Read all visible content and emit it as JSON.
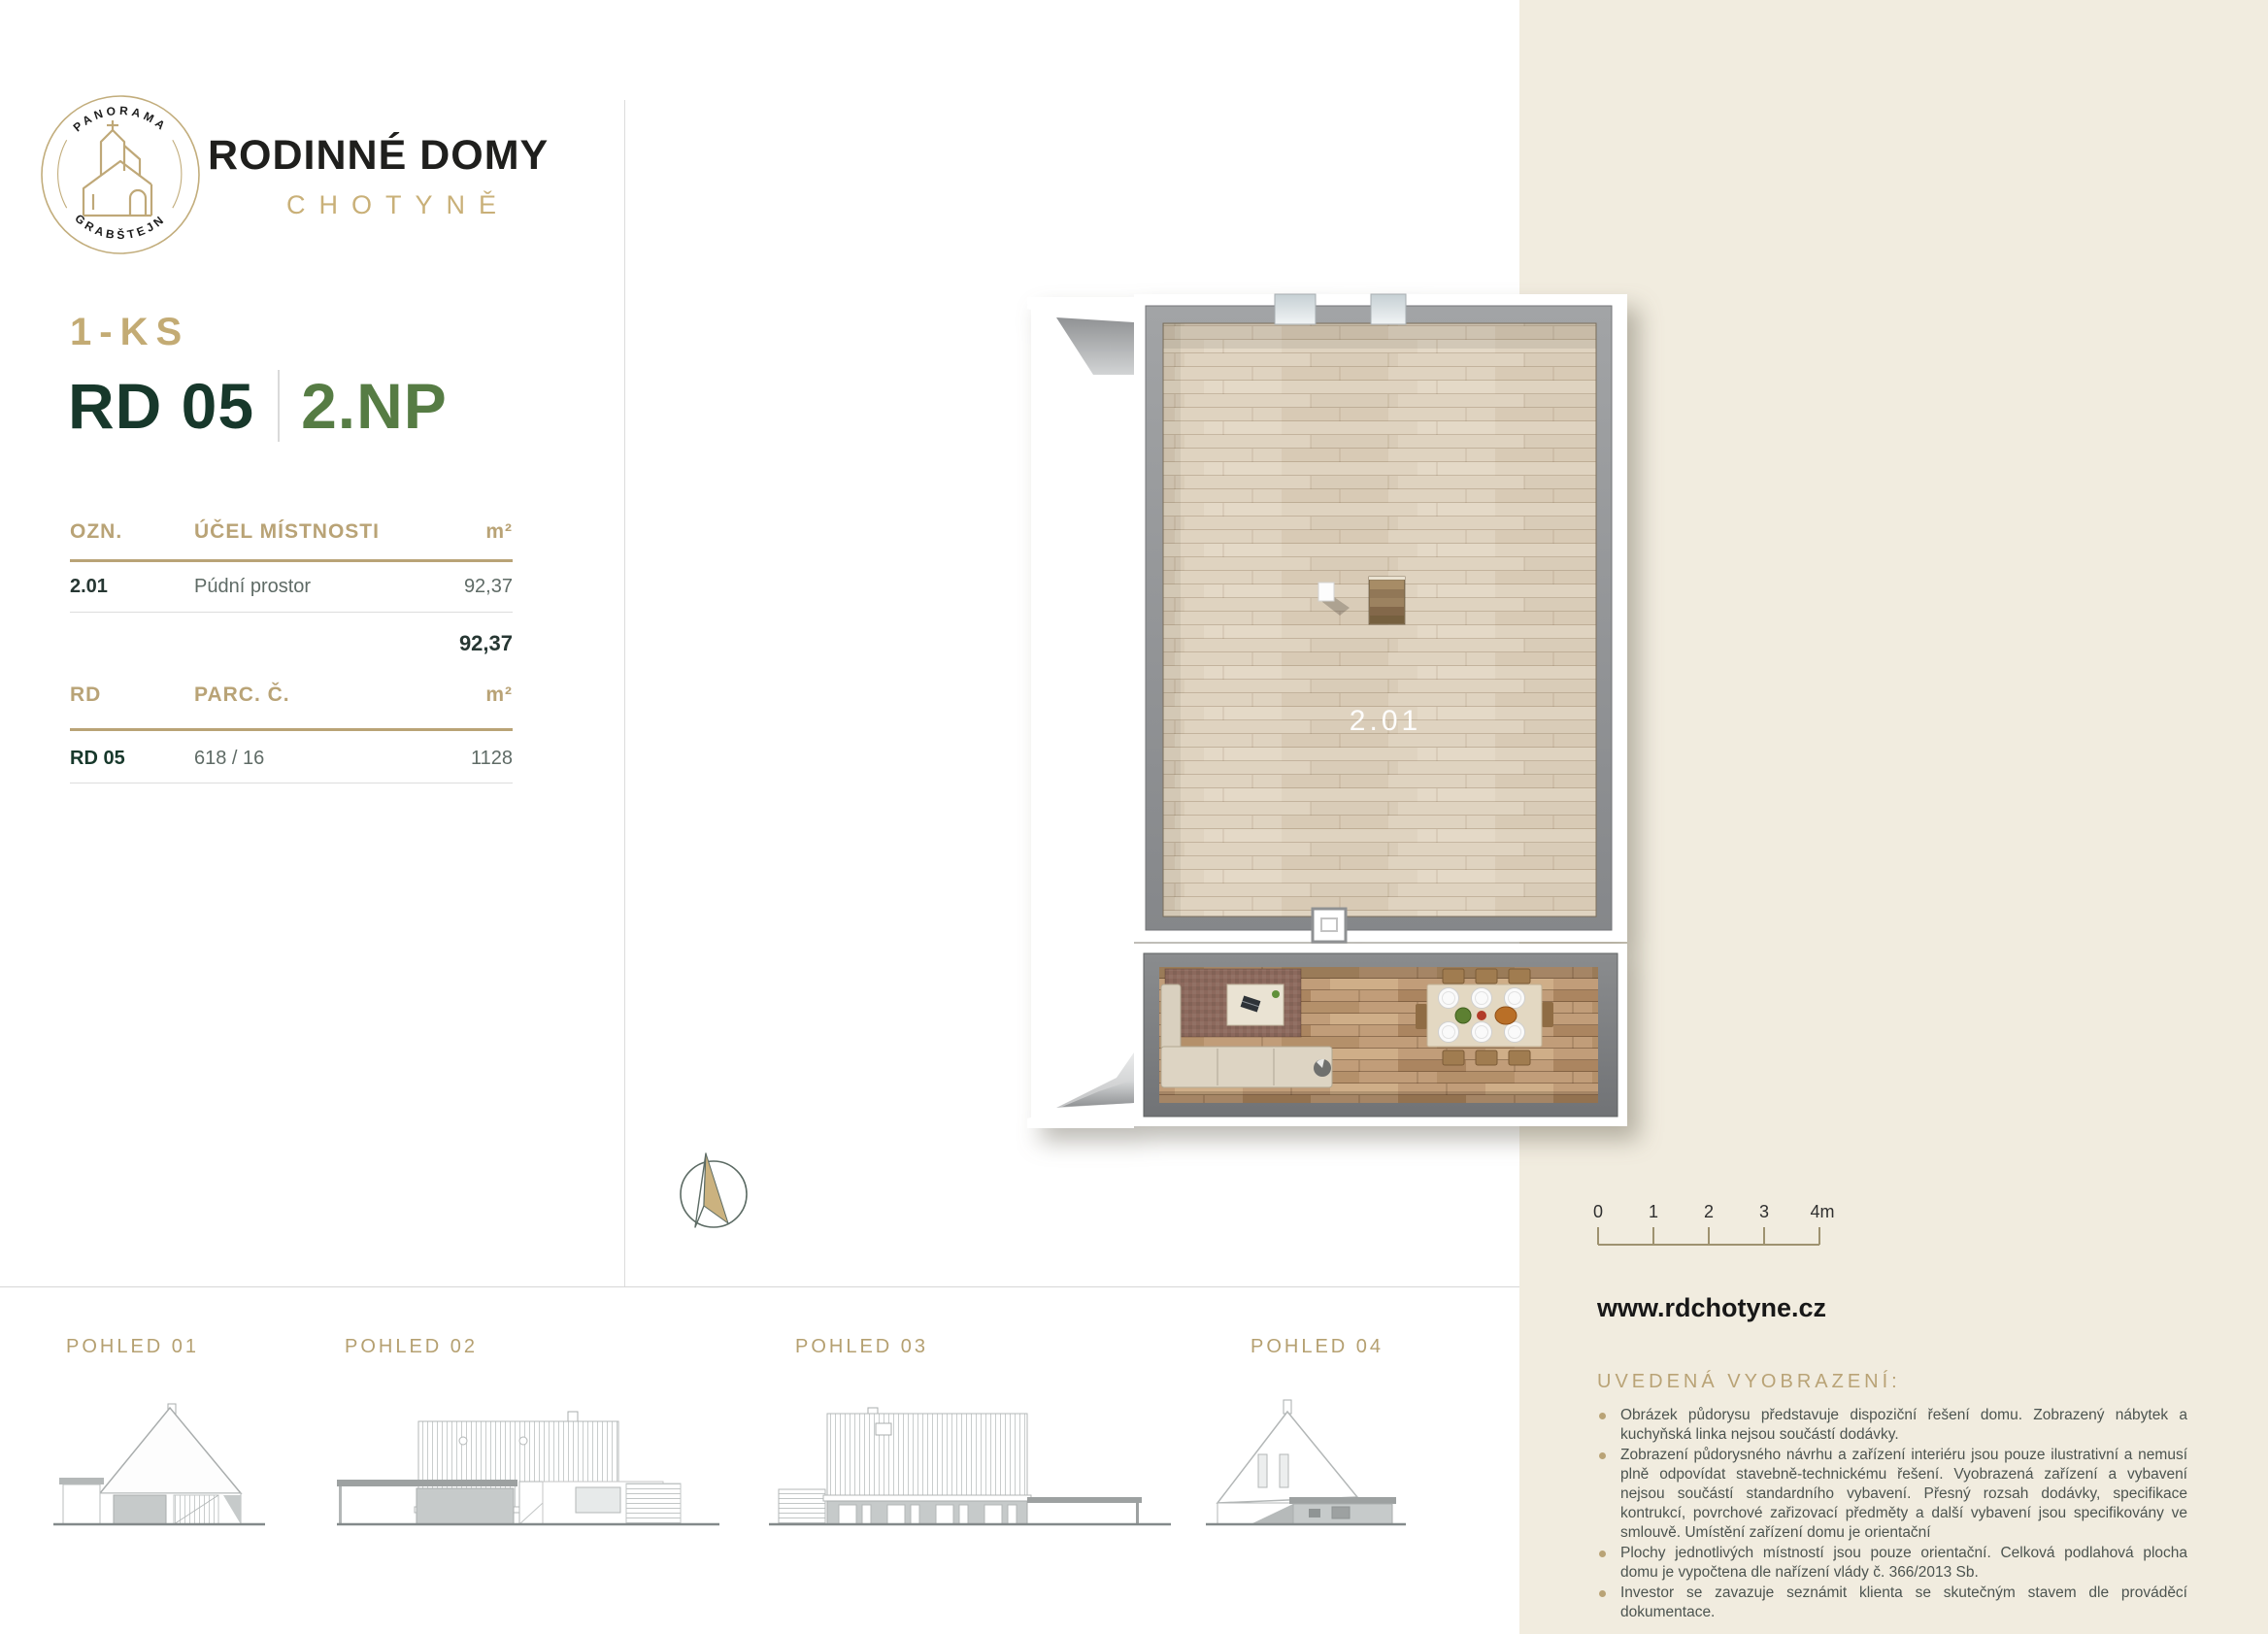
{
  "brand": {
    "ring_top": "PANORAMA",
    "ring_bottom": "GRABŠTEJN",
    "title": "RODINNÉ DOMY",
    "subtitle": "CHOTYNĚ"
  },
  "unit": {
    "type_label": "1-KS",
    "house_id": "RD 05",
    "floor": "2.NP"
  },
  "rooms_table": {
    "headers": [
      "OZN.",
      "ÚČEL MÍSTNOSTI",
      "m²"
    ],
    "rows": [
      {
        "ozn": "2.01",
        "name": "Púdní prostor",
        "area": "92,37"
      }
    ],
    "total": "92,37"
  },
  "parcel_table": {
    "headers": [
      "RD",
      "PARC. Č.",
      "m²"
    ],
    "rows": [
      {
        "rd": "RD 05",
        "parc": "618 / 16",
        "area": "1128"
      }
    ]
  },
  "plan": {
    "room_label": "2.01"
  },
  "scalebar": {
    "ticks": [
      "0",
      "1",
      "2",
      "3",
      "4m"
    ]
  },
  "website": "www.rdchotyne.cz",
  "disclaimer": {
    "heading": "UVEDENÁ VYOBRAZENÍ:",
    "items": [
      "Obrázek půdorysu představuje dispoziční řešení domu. Zobrazený nábytek a kuchyňská linka nejsou součástí dodávky.",
      "Zobrazení půdorysného návrhu a zařízení interiéru jsou pouze ilustrativní a nemusí plně odpovídat stavebně-technickému řešení. Vyobrazená zařízení a vybavení nejsou součástí standardního vybavení. Přesný rozsah dodávky, specifikace kontrukcí, povrchové zařizovací předměty a další vybavení jsou specifikovány ve smlouvě. Umístění zařízení domu je orientační",
      "Plochy jednotlivých místností jsou pouze orientační. Celková podlahová plocha domu je vypočtena dle nařízení vlády č. 366/2013 Sb.",
      "Investor se zavazuje seznámit klienta se skutečným stavem dle prováděcí dokumentace."
    ]
  },
  "views": [
    {
      "label": "POHLED 01"
    },
    {
      "label": "POHLED 02"
    },
    {
      "label": "POHLED 03"
    },
    {
      "label": "POHLED 04"
    }
  ],
  "colors": {
    "gold": "#b9a376",
    "dark_green": "#17382b",
    "mid_green": "#567c44",
    "beige_panel": "#f1ecdf",
    "wood_light": "#dfd3c0",
    "wood_dark": "#c19d79",
    "wall_gray": "#8f9193"
  }
}
